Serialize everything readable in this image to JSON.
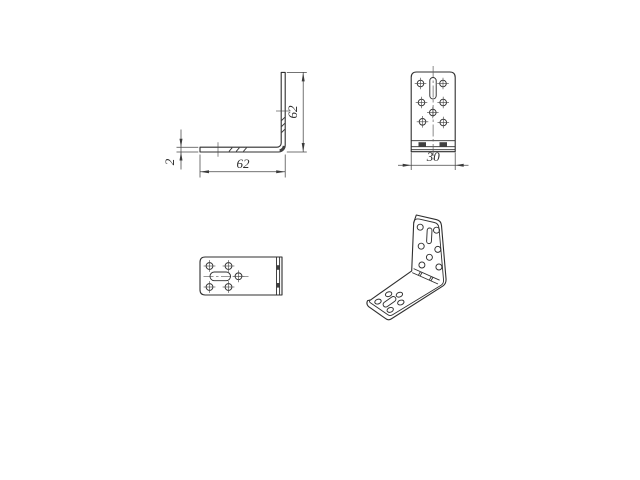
{
  "drawing": {
    "title": "Angle bracket engineering drawing, four views",
    "background_color": "#ffffff",
    "line_color": "#2f2f2f",
    "dimension_color": "#454545",
    "views": {
      "side": {
        "label": "side profile view (L-section)",
        "dim_height": "62",
        "dim_length": "62",
        "dim_thickness": "2"
      },
      "front": {
        "label": "front view of vertical leg",
        "dim_width": "30",
        "holes": 7,
        "slots": 1
      },
      "top": {
        "label": "top view of horizontal leg",
        "holes": 5,
        "slots": 1
      },
      "isometric": {
        "label": "isometric view",
        "vertical_face_holes": 7,
        "horizontal_face_holes": 5,
        "slots": 2
      }
    }
  }
}
